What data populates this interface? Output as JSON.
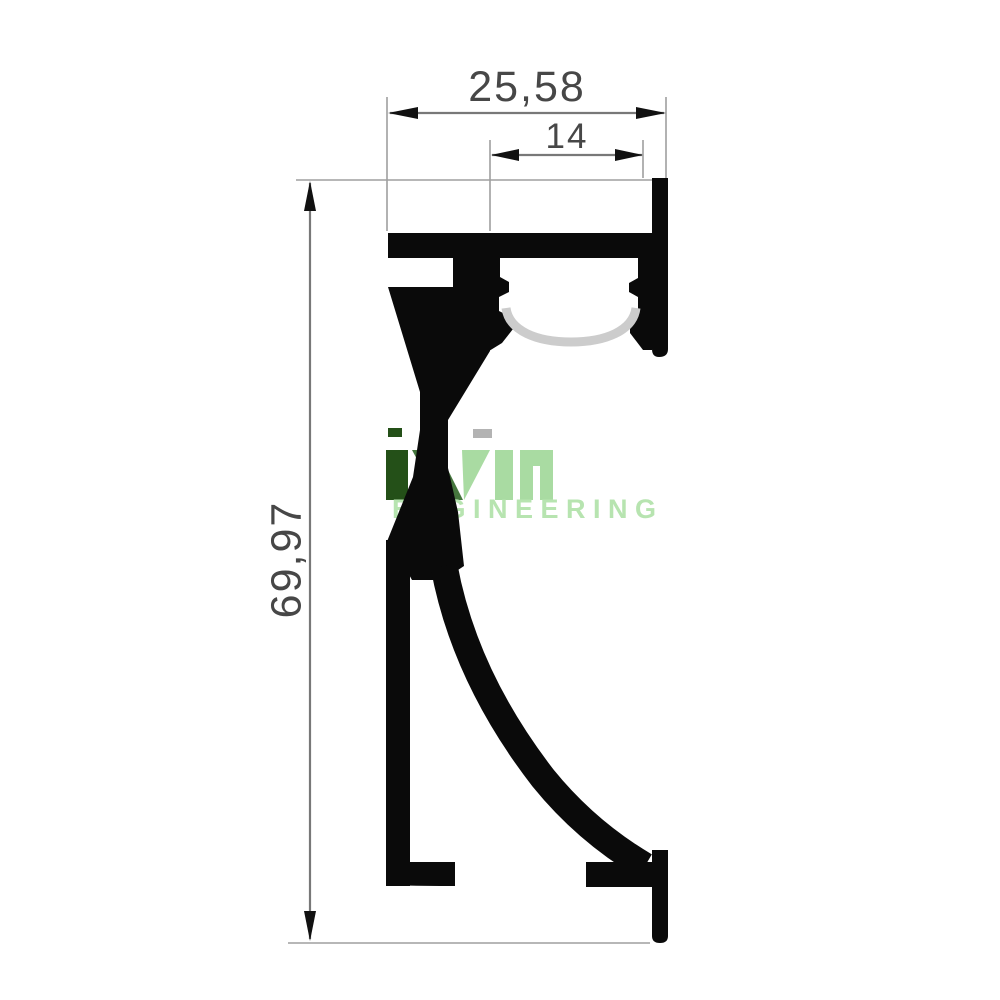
{
  "drawing": {
    "description": "Aluminium LED profile cross-section technical drawing",
    "dimensions": {
      "top_width": "25,58",
      "slot_width": "14",
      "height": "69,97"
    }
  },
  "watermark": {
    "brand": "ivin",
    "subtitle": "ENGINEERING",
    "colors": {
      "dark": "#245018",
      "mid": "#46773e",
      "light": "#a9dba2",
      "dot": "#b3b3b3",
      "sub": "#b7e4b0"
    }
  },
  "colors": {
    "background": "#ffffff",
    "profile": "#0a0a0a",
    "diffuser": "#cccccc",
    "dim-line": "#787878",
    "ext-line": "#9f9f9f",
    "arrow": "#111111",
    "dim-text": "#474747"
  }
}
